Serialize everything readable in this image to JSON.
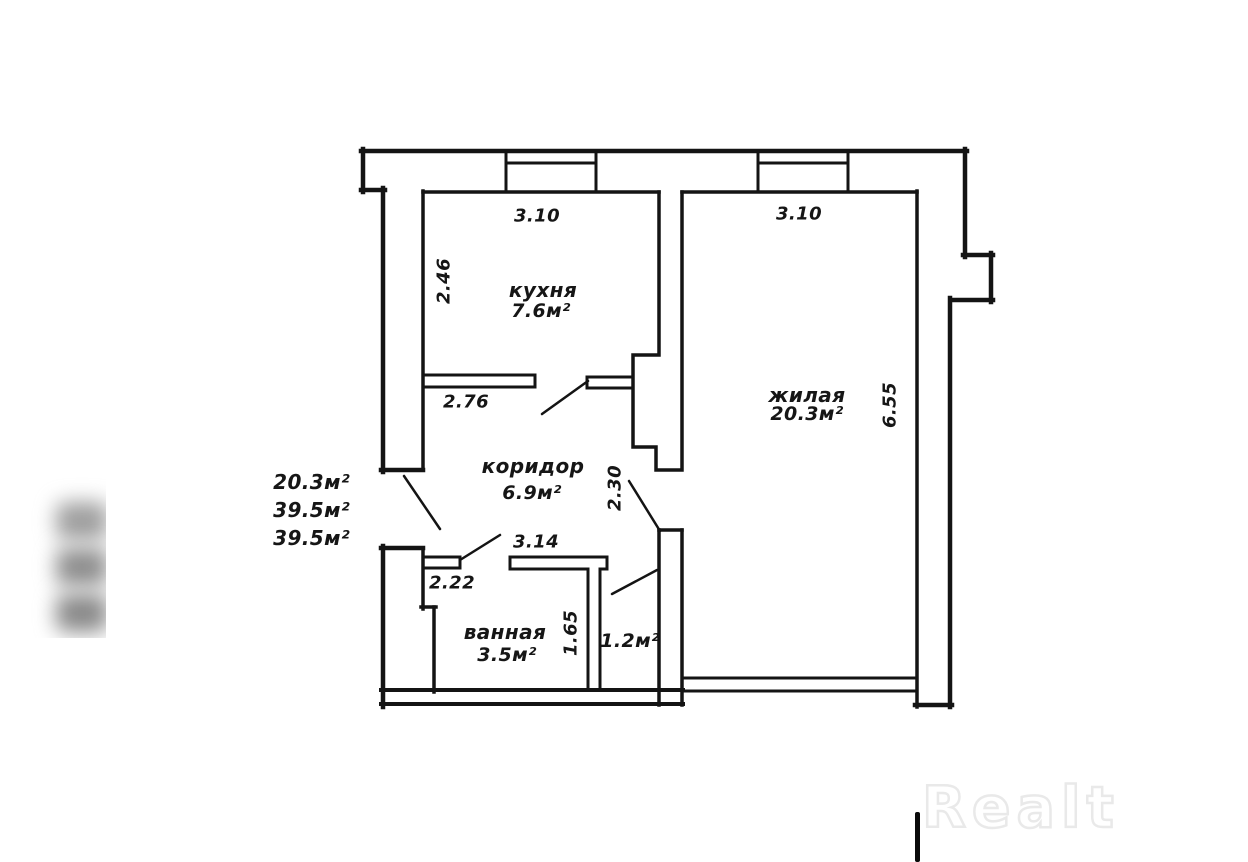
{
  "plan": {
    "rooms": {
      "kitchen": {
        "name": "кухня",
        "area": "7.6м²"
      },
      "living": {
        "name": "жилая",
        "area": "20.3м²"
      },
      "corridor": {
        "name": "коридор",
        "area": "6.9м²"
      },
      "bathroom": {
        "name": "ванная",
        "area": "3.5м²"
      },
      "closet": {
        "area": "1.2м²"
      }
    },
    "dimensions": {
      "kitchen_top": "3.10",
      "living_top": "3.10",
      "kitchen_left": "2.46",
      "kitchen_bottom": "2.76",
      "corridor_bottom": "3.14",
      "living_door": "2.30",
      "bath_top": "2.22",
      "bath_height": "1.65",
      "living_right": "6.55"
    },
    "side_notes": [
      "20.3м²",
      "39.5м²",
      "39.5м²"
    ],
    "line_color": "#141414"
  },
  "watermark": {
    "logo": "Realt"
  }
}
